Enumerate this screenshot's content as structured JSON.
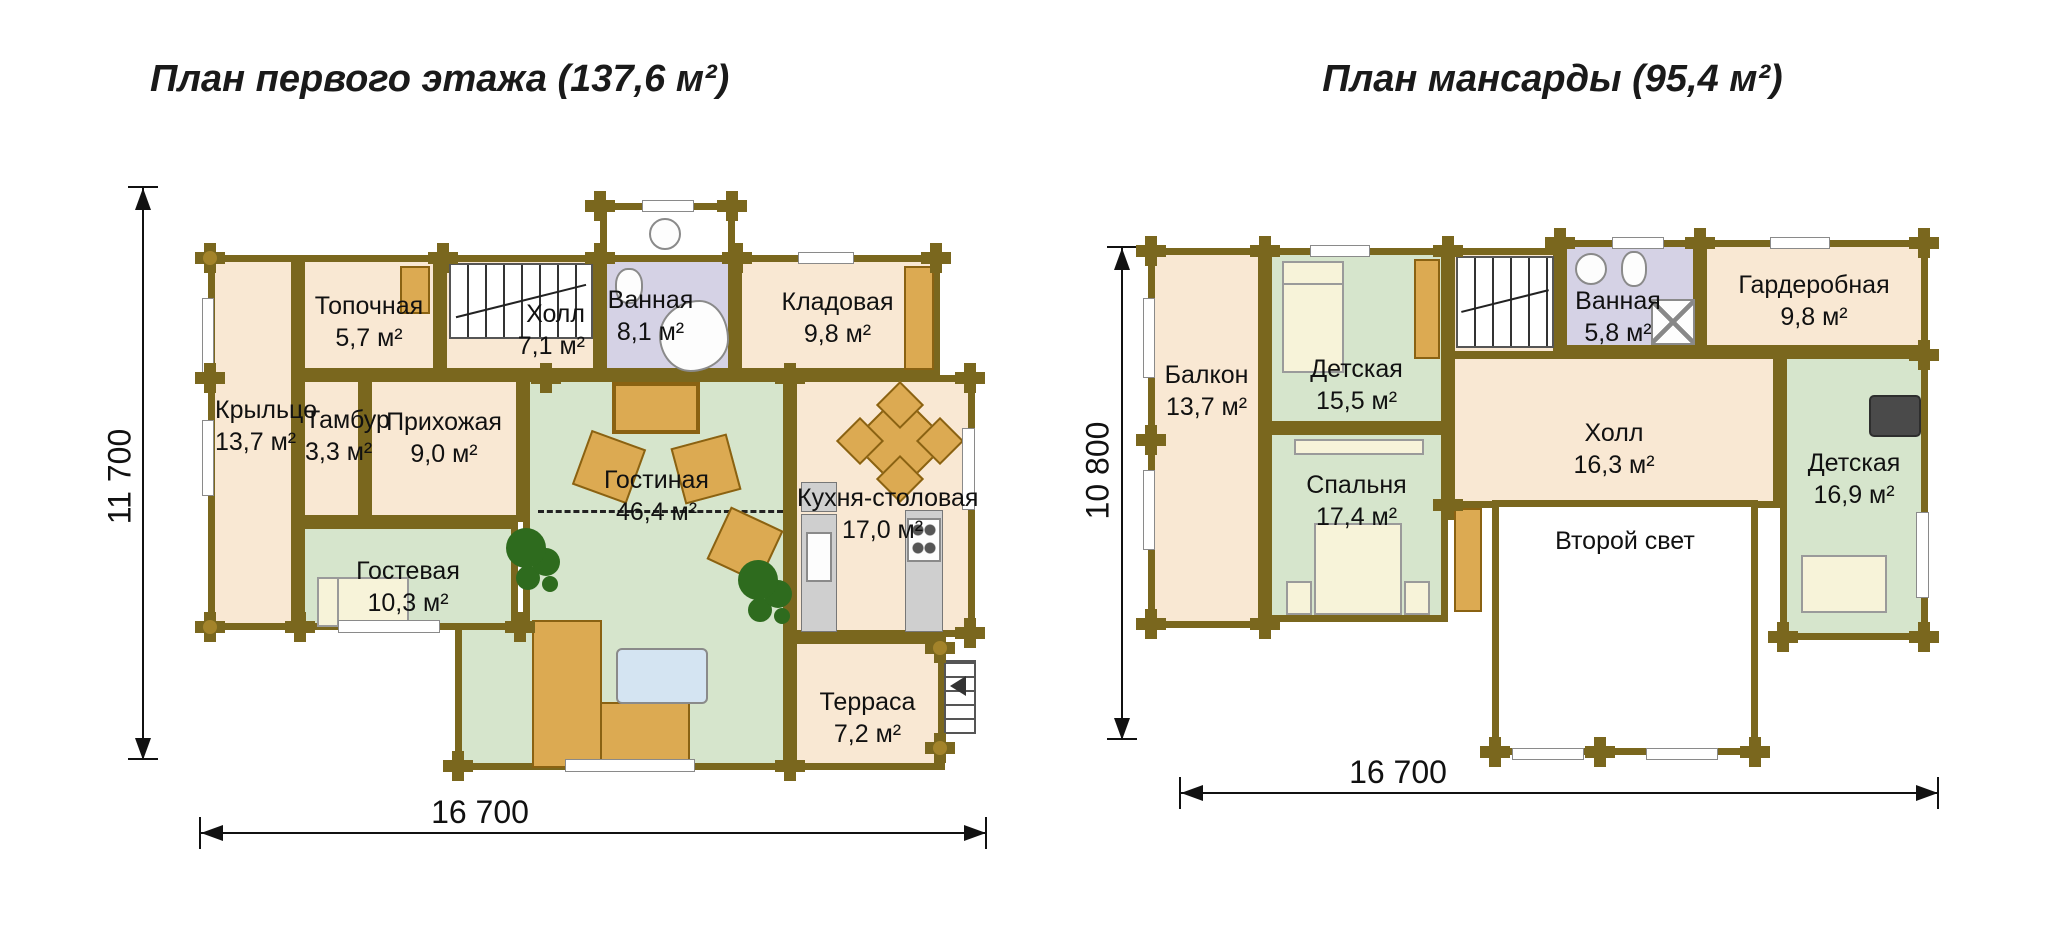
{
  "left": {
    "title": "План первого этажа (137,6 м²)",
    "height_label": "11 700",
    "width_label": "16 700",
    "rooms": {
      "kryltso": {
        "name": "Крыльцо",
        "area": "13,7 м²"
      },
      "topochnaya": {
        "name": "Топочная",
        "area": "5,7 м²"
      },
      "holl": {
        "name": "Холл",
        "area": "7,1 м²"
      },
      "vannaya": {
        "name": "Ванная",
        "area": "8,1 м²"
      },
      "kladovaya": {
        "name": "Кладовая",
        "area": "9,8 м²"
      },
      "tambur": {
        "name": "Тамбур",
        "area": "3,3 м²"
      },
      "prihozhaya": {
        "name": "Прихожая",
        "area": "9,0 м²"
      },
      "gostinaya": {
        "name": "Гостиная",
        "area": "46,4 м²"
      },
      "kuhnya": {
        "name": "Кухня-столовая",
        "area": "17,0 м²"
      },
      "gostevaya": {
        "name": "Гостевая",
        "area": "10,3 м²"
      },
      "terrasa": {
        "name": "Терраса",
        "area": "7,2 м²"
      }
    }
  },
  "right": {
    "title": "План мансарды (95,4 м²)",
    "height_label": "10 800",
    "width_label": "16 700",
    "rooms": {
      "balkon": {
        "name": "Балкон",
        "area": "13,7 м²"
      },
      "detskaya1": {
        "name": "Детская",
        "area": "15,5 м²"
      },
      "vannaya": {
        "name": "Ванная",
        "area": "5,8 м²"
      },
      "garderobnaya": {
        "name": "Гардеробная",
        "area": "9,8 м²"
      },
      "spalnya": {
        "name": "Спальня",
        "area": "17,4 м²"
      },
      "holl": {
        "name": "Холл",
        "area": "16,3 м²"
      },
      "detskaya2": {
        "name": "Детская",
        "area": "16,9 м²"
      },
      "vtoroy_svet": {
        "name": "Второй свет",
        "area": ""
      }
    }
  },
  "colors": {
    "wall": "#7a671e",
    "room_cream": "#f9e8d3",
    "room_green": "#d6e5cc",
    "room_lavender": "#d5d2e5",
    "furniture_tan": "#dcaa52"
  }
}
